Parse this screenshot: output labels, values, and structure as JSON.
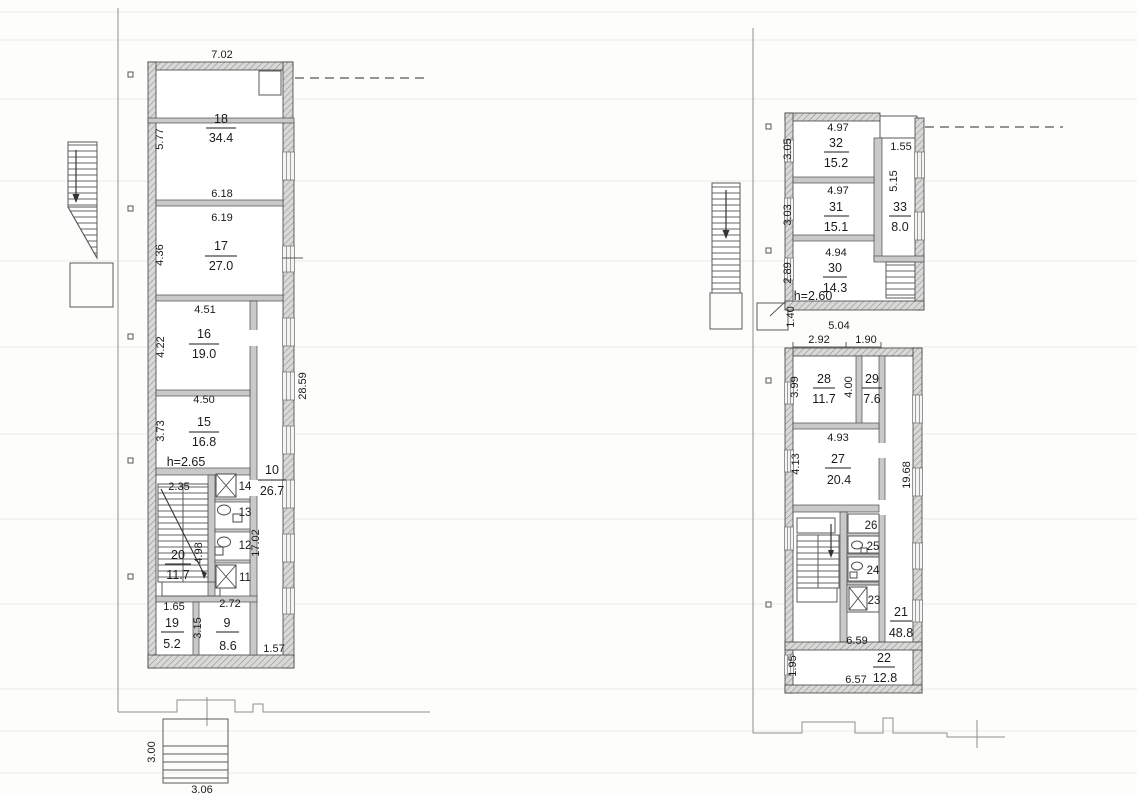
{
  "document": {
    "type": "scanned-floor-plan",
    "sheets": [
      "left-wing-plan",
      "right-wing-plan"
    ]
  },
  "left_plan": {
    "height_note": "h=2.65",
    "rooms": {
      "r18": {
        "num": "18",
        "area": "34.4"
      },
      "r17": {
        "num": "17",
        "area": "27.0"
      },
      "r16": {
        "num": "16",
        "area": "19.0"
      },
      "r15": {
        "num": "15",
        "area": "16.8"
      },
      "r20": {
        "num": "20",
        "area": "11.7"
      },
      "r19": {
        "num": "19",
        "area": "5.2"
      },
      "r9": {
        "num": "9",
        "area": "8.6"
      },
      "r10": {
        "num": "10",
        "area": "26.7"
      },
      "r14": {
        "num": "14"
      },
      "r13": {
        "num": "13"
      },
      "r12": {
        "num": "12"
      },
      "r11": {
        "num": "11"
      }
    },
    "dims": {
      "top_width": "7.02",
      "r18_height": "5.77",
      "r18_width": "6.18",
      "r17_width": "6.19",
      "r17_height": "4.36",
      "r16_width": "4.51",
      "r16_height": "4.22",
      "r15_width": "4.50",
      "r15_height": "3.73",
      "stair_width": "2.35",
      "stair_height": "4.98",
      "r19_width": "1.65",
      "r9_width": "2.72",
      "r9_height": "3.15",
      "bottom_right": "1.57",
      "east_total": "28.59",
      "corridor_length": "17.02",
      "porch_depth": "3.00",
      "porch_width": "3.06"
    }
  },
  "right_plan": {
    "height_note": "h=2.60",
    "rooms": {
      "r32": {
        "num": "32",
        "area": "15.2"
      },
      "r31": {
        "num": "31",
        "area": "15.1"
      },
      "r33": {
        "num": "33",
        "area": "8.0"
      },
      "r30": {
        "num": "30",
        "area": "14.3"
      },
      "r28": {
        "num": "28",
        "area": "11.7"
      },
      "r29": {
        "num": "29",
        "area": "7.6"
      },
      "r27": {
        "num": "27",
        "area": "20.4"
      },
      "r21": {
        "num": "21",
        "area": "48.8"
      },
      "r22": {
        "num": "22",
        "area": "12.8"
      },
      "r26": {
        "num": "26"
      },
      "r25": {
        "num": "25"
      },
      "r24": {
        "num": "24"
      },
      "r23": {
        "num": "23"
      }
    },
    "dims": {
      "r32_width": "4.97",
      "r32_height": "3.05",
      "niche_width": "1.55",
      "r31_width": "4.97",
      "r31_height": "3.03",
      "r33_height": "5.15",
      "r30_width": "4.94",
      "r30_height": "2.89",
      "mid_width": "5.04",
      "mid_left": "2.92",
      "mid_right": "1.90",
      "mid_height": "1.40",
      "r28_height": "3.99",
      "r29_height": "4.00",
      "r27_width": "4.93",
      "r27_height": "4.13",
      "east_total": "19.68",
      "stair_width": "6.59",
      "r22_width": "6.57",
      "r22_height": "1.95"
    }
  }
}
